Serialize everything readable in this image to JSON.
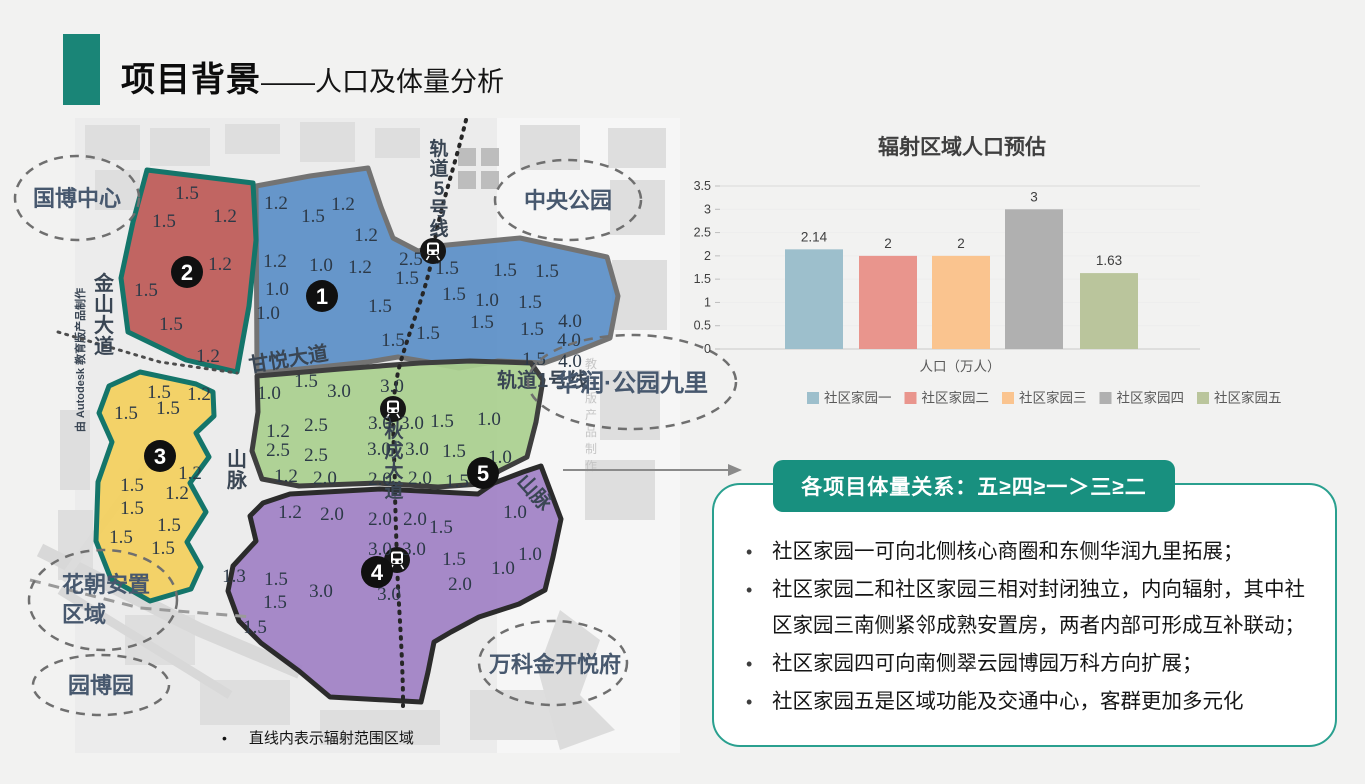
{
  "slide": {
    "title_bold": "项目背景",
    "title_rest": "——人口及体量分析",
    "accent_color": "#1a8577",
    "caption_bullet": "•"
  },
  "map": {
    "caption": "直线内表示辐射范围区域",
    "watermark": "由 Autodesk 教育版产品制作",
    "watermark_short": "教育版产品制作",
    "landmarks": {
      "guobo": "国博中心",
      "zhongyang": "中央公园",
      "huarun": "华润·公园九里",
      "huachao_line1": "花朝安置",
      "huachao_line2": "区域",
      "yuanbo": "园博园",
      "wanke": "万科金开悦府"
    },
    "roads": {
      "jinshan": "金山大道",
      "ganyue": "甘悦大道",
      "rail5": "轨道5号线",
      "rail1": "轨道1号线",
      "qiucheng": "秋成大道",
      "shan_left": "山脉",
      "shan_right": "山脉"
    },
    "zones": [
      {
        "id": "1",
        "name": "社区家园一",
        "marker": "1",
        "fill": "rgba(88,141,199,0.9)",
        "stroke": "#737373",
        "marker_x": 322,
        "marker_y": 186,
        "values": [
          {
            "v": "1.2",
            "x": 276,
            "y": 92
          },
          {
            "v": "1.5",
            "x": 313,
            "y": 105
          },
          {
            "v": "1.2",
            "x": 343,
            "y": 93
          },
          {
            "v": "1.2",
            "x": 366,
            "y": 124
          },
          {
            "v": "1.2",
            "x": 275,
            "y": 150
          },
          {
            "v": "1.0",
            "x": 321,
            "y": 154
          },
          {
            "v": "1.2",
            "x": 360,
            "y": 156
          },
          {
            "v": "2.5",
            "x": 411,
            "y": 148
          },
          {
            "v": "1.5",
            "x": 407,
            "y": 167
          },
          {
            "v": "1.0",
            "x": 277,
            "y": 178
          },
          {
            "v": "1.0",
            "x": 268,
            "y": 202
          },
          {
            "v": "1.5",
            "x": 380,
            "y": 195
          },
          {
            "v": "1.5",
            "x": 447,
            "y": 157
          },
          {
            "v": "1.5",
            "x": 505,
            "y": 159
          },
          {
            "v": "1.5",
            "x": 547,
            "y": 160
          },
          {
            "v": "1.5",
            "x": 454,
            "y": 183
          },
          {
            "v": "1.0",
            "x": 487,
            "y": 189
          },
          {
            "v": "1.5",
            "x": 530,
            "y": 191
          },
          {
            "v": "1.5",
            "x": 482,
            "y": 211
          },
          {
            "v": "1.5",
            "x": 532,
            "y": 218
          },
          {
            "v": "4.0",
            "x": 570,
            "y": 210
          },
          {
            "v": "4.0",
            "x": 569,
            "y": 229
          },
          {
            "v": "1.5",
            "x": 534,
            "y": 248
          },
          {
            "v": "4.0",
            "x": 570,
            "y": 250
          },
          {
            "v": "1.5",
            "x": 428,
            "y": 222
          },
          {
            "v": "1.5",
            "x": 393,
            "y": 229
          }
        ]
      },
      {
        "id": "2",
        "name": "社区家园二",
        "marker": "2",
        "fill": "rgba(189,87,83,0.9)",
        "stroke": "#14756a",
        "marker_x": 187,
        "marker_y": 162,
        "values": [
          {
            "v": "1.5",
            "x": 187,
            "y": 82
          },
          {
            "v": "1.2",
            "x": 225,
            "y": 105
          },
          {
            "v": "1.5",
            "x": 164,
            "y": 110
          },
          {
            "v": "1.2",
            "x": 220,
            "y": 153
          },
          {
            "v": "1.5",
            "x": 146,
            "y": 179
          },
          {
            "v": "1.5",
            "x": 171,
            "y": 213
          },
          {
            "v": "1.2",
            "x": 208,
            "y": 245
          }
        ]
      },
      {
        "id": "3",
        "name": "社区家园三",
        "marker": "3",
        "fill": "rgba(243,208,94,0.93)",
        "stroke": "#14756a",
        "marker_x": 160,
        "marker_y": 346,
        "values": [
          {
            "v": "1.5",
            "x": 159,
            "y": 281
          },
          {
            "v": "1.2",
            "x": 199,
            "y": 283
          },
          {
            "v": "1.5",
            "x": 168,
            "y": 297
          },
          {
            "v": "1.5",
            "x": 126,
            "y": 302
          },
          {
            "v": "1.2",
            "x": 190,
            "y": 362
          },
          {
            "v": "1.2",
            "x": 177,
            "y": 382
          },
          {
            "v": "1.5",
            "x": 132,
            "y": 374
          },
          {
            "v": "1.5",
            "x": 132,
            "y": 397
          },
          {
            "v": "1.5",
            "x": 121,
            "y": 426
          },
          {
            "v": "1.5",
            "x": 169,
            "y": 414
          },
          {
            "v": "1.5",
            "x": 163,
            "y": 437
          }
        ]
      },
      {
        "id": "4",
        "name": "社区家园四",
        "marker": "4",
        "fill": "rgba(160,128,196,0.92)",
        "stroke": "#2b2b2b",
        "marker_x": 377,
        "marker_y": 462,
        "values": [
          {
            "v": "1.2",
            "x": 290,
            "y": 401
          },
          {
            "v": "2.0",
            "x": 332,
            "y": 403
          },
          {
            "v": "2.0",
            "x": 380,
            "y": 408
          },
          {
            "v": "2.0",
            "x": 415,
            "y": 408
          },
          {
            "v": "1.5",
            "x": 441,
            "y": 416
          },
          {
            "v": "1.0",
            "x": 515,
            "y": 401
          },
          {
            "v": "3.0",
            "x": 380,
            "y": 438
          },
          {
            "v": "3.0",
            "x": 414,
            "y": 438
          },
          {
            "v": "1.5",
            "x": 454,
            "y": 448
          },
          {
            "v": "1.0",
            "x": 503,
            "y": 457
          },
          {
            "v": "1.0",
            "x": 530,
            "y": 443
          },
          {
            "v": "1.3",
            "x": 234,
            "y": 465
          },
          {
            "v": "1.5",
            "x": 276,
            "y": 468
          },
          {
            "v": "3.0",
            "x": 321,
            "y": 480
          },
          {
            "v": "1.5",
            "x": 275,
            "y": 491
          },
          {
            "v": "1.5",
            "x": 255,
            "y": 516
          },
          {
            "v": "3.0",
            "x": 389,
            "y": 483
          },
          {
            "v": "2.0",
            "x": 460,
            "y": 473
          }
        ]
      },
      {
        "id": "5",
        "name": "社区家园五",
        "marker": "5",
        "fill": "rgba(170,208,143,0.93)",
        "stroke": "#3e3e3e",
        "marker_x": 483,
        "marker_y": 363,
        "values": [
          {
            "v": "1.0",
            "x": 269,
            "y": 282
          },
          {
            "v": "1.5",
            "x": 306,
            "y": 270
          },
          {
            "v": "3.0",
            "x": 339,
            "y": 280
          },
          {
            "v": "3.0",
            "x": 392,
            "y": 275
          },
          {
            "v": "1.2",
            "x": 278,
            "y": 320
          },
          {
            "v": "2.5",
            "x": 316,
            "y": 314
          },
          {
            "v": "3.0",
            "x": 380,
            "y": 312
          },
          {
            "v": "3.0",
            "x": 412,
            "y": 312
          },
          {
            "v": "1.5",
            "x": 442,
            "y": 310
          },
          {
            "v": "1.0",
            "x": 489,
            "y": 308
          },
          {
            "v": "2.5",
            "x": 278,
            "y": 339
          },
          {
            "v": "2.5",
            "x": 316,
            "y": 344
          },
          {
            "v": "3.0",
            "x": 379,
            "y": 338
          },
          {
            "v": "3.0",
            "x": 417,
            "y": 338
          },
          {
            "v": "1.5",
            "x": 454,
            "y": 340
          },
          {
            "v": "1.0",
            "x": 500,
            "y": 346
          },
          {
            "v": "1.2",
            "x": 286,
            "y": 365
          },
          {
            "v": "2.0",
            "x": 325,
            "y": 367
          },
          {
            "v": "2.0",
            "x": 380,
            "y": 368
          },
          {
            "v": "2.0",
            "x": 420,
            "y": 367
          },
          {
            "v": "1.5",
            "x": 457,
            "y": 370
          }
        ]
      }
    ]
  },
  "chart_data": {
    "type": "bar",
    "title": "辐射区域人口预估",
    "categories": [
      "社区家园一",
      "社区家园二",
      "社区家园三",
      "社区家园四",
      "社区家园五"
    ],
    "values": [
      2.14,
      2,
      2,
      3,
      1.63
    ],
    "value_labels": [
      "2.14",
      "2",
      "2",
      "3",
      "1.63"
    ],
    "colors": [
      "#9dbfcc",
      "#e9958d",
      "#fac48f",
      "#b0b0b0",
      "#bac59c"
    ],
    "xlabel": "人口（万人）",
    "ylabel": "",
    "ylim": [
      0,
      3.5
    ],
    "yticks": [
      0,
      0.5,
      1,
      1.5,
      2,
      2.5,
      3,
      3.5
    ],
    "grid": "horizontal-light",
    "legend_position": "bottom"
  },
  "panel": {
    "banner": "各项目体量关系：五≥四≥一＞三≥二",
    "bullets": [
      "社区家园一可向北侧核心商圈和东侧华润九里拓展；",
      "社区家园二和社区家园三相对封闭独立，内向辐射，其中社区家园三南侧紧邻成熟安置房，两者内部可形成互补联动；",
      "社区家园四可向南侧翠云园博园万科方向扩展；",
      "社区家园五是区域功能及交通中心，客群更加多元化"
    ]
  }
}
